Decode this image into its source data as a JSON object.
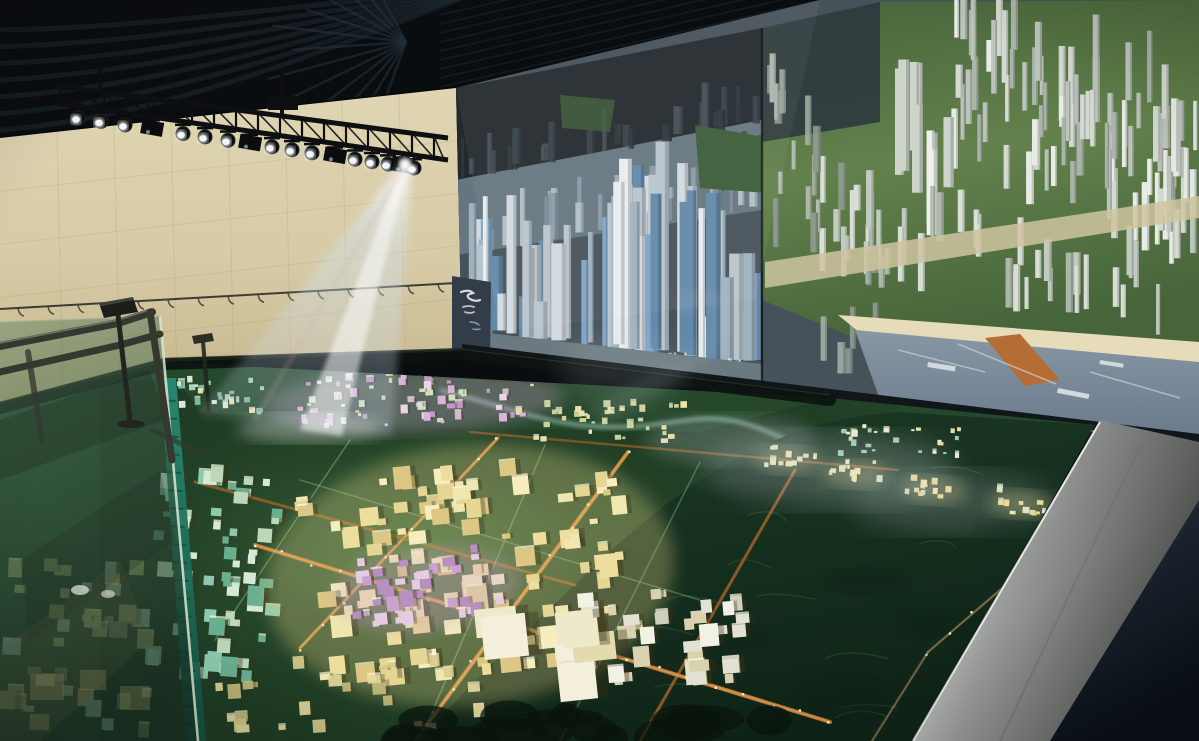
{
  "scene": {
    "label": "urban-planning-exhibition-hall",
    "elements": [
      "ceiling-swirl-panels",
      "spotlight-truss",
      "projector-beam",
      "tiled-wall",
      "video-wall-city-render",
      "residential-screen-panel",
      "city-scale-model",
      "glass-display-case",
      "metal-railing",
      "info-stand",
      "silver-table-edge",
      "mist-effect"
    ]
  },
  "palette": {
    "ceiling": "#0a0d10",
    "ceilingStripe": "#1d2a31",
    "ceilingRay": "#243039",
    "truss": "#0d0f11",
    "wall": "#d7cba6",
    "wallHi": "#e0d5b2",
    "wallShade": "#c3b489",
    "wallLine": "#8a7a52",
    "wire": "#3c3c32",
    "screenDark": "#232a2d",
    "screenDark2": "#2e383e",
    "screenMid": "#9aa7ae",
    "park": "#3c5c38",
    "hillB": "#62814c",
    "hillB2": "#47653a",
    "roadB": "#cfc4a0",
    "beach": "#e6dcba",
    "seaTop": "#8797a5",
    "seaBot": "#69798a",
    "pier": "#b56d36",
    "pierWhite": "#dce2e6",
    "bezel": "#10161a",
    "seam": "#0b0f12",
    "sidePanel": "#333d49",
    "calligraphy": "#e9edf1",
    "modelBase": "#24482c",
    "modelLight": "#3c6b3e",
    "hillsBack": "#26492c",
    "mountain1": "#1c3b25",
    "mountain2": "#0f2418",
    "ridge": "#3f6b35",
    "river": "#a8cdc4",
    "roadOrange": "#c8803a",
    "roadOrange2": "#a86628",
    "roadTan": "#c9a06a",
    "roadGreen": "#9fd0a0",
    "lightDot": "#fff8dc",
    "tealEdge": "#2a8a72",
    "tealEdgeDark": "#14503f",
    "glassTop": "#56805f",
    "glassBot": "#182c22",
    "glassEdge": "#d8e8d0",
    "rail": "#34382f",
    "railHi": "#7d8277",
    "standDark": "#1b1e1a",
    "silver1": "#f2f2ef",
    "silver2": "#9a9d9a",
    "silver3": "#51544f",
    "floor1": "#2a3745",
    "floor2": "#0c121a",
    "wallPiece": "#857f6d",
    "beamCore": "#ffffff",
    "beamEdge": "#cfe2f4",
    "beamPink": "#d9a8b0",
    "mist": "#ccd4d9"
  },
  "ceiling": {
    "swirl_count": 7,
    "ray_count": 13,
    "slat_count": 9
  },
  "truss": {
    "spotlight_xs": [
      78,
      101,
      125,
      152,
      183,
      205,
      228,
      250,
      272,
      292,
      312,
      335,
      355,
      372,
      388,
      402,
      414
    ],
    "box_indices": [
      3,
      7,
      11,
      15
    ],
    "lattice_step": 22
  },
  "wall": {
    "v_lines": 7,
    "h_lines": 4,
    "wire_hooks": 15
  },
  "videowall": {
    "seam_x": 762,
    "districts": [
      {
        "name": "far-silhouette",
        "x0": 462,
        "x1": 758,
        "b0": 178,
        "b1": 120,
        "n": 26,
        "w": [
          4,
          10
        ],
        "h": [
          14,
          45
        ],
        "colors": [
          "#39444b",
          "#2e383e",
          "#46525a"
        ],
        "op": 0.9
      },
      {
        "name": "mid-city",
        "x0": 462,
        "x1": 758,
        "b0": 252,
        "b1": 206,
        "n": 34,
        "w": [
          4,
          9
        ],
        "h": [
          18,
          60
        ],
        "colors": [
          "#9fadb6",
          "#8b9ba6",
          "#b6c2ca",
          "#7d8d99"
        ],
        "op": 0.95
      },
      {
        "name": "cbd-towers",
        "x0": 468,
        "x1": 756,
        "b0": 330,
        "b1": 364,
        "n": 58,
        "w": [
          5,
          15
        ],
        "h": [
          35,
          150
        ],
        "colors": [
          "#e8edf0",
          "#d3dbe0",
          "#b9c5cd",
          "#9fb2bf",
          "#7fa3c6",
          "#6288aa"
        ],
        "op": 1,
        "center_boost": true
      },
      {
        "name": "residential-dense",
        "x0": 952,
        "x1": 1196,
        "b0": 95,
        "b1": 195,
        "n": 85,
        "w": [
          4,
          8
        ],
        "h": [
          30,
          75
        ],
        "yj": 80,
        "colors": [
          "#e8ece6",
          "#d4dad2",
          "#bcc5bb",
          "#aab4a9"
        ],
        "op": 1
      },
      {
        "name": "residential-tall-pair",
        "x0": 884,
        "x1": 950,
        "b0": 150,
        "b1": 215,
        "n": 9,
        "w": [
          7,
          11
        ],
        "h": [
          70,
          135
        ],
        "yj": 40,
        "colors": [
          "#eef1ec",
          "#dde3db",
          "#cdd5cb"
        ],
        "op": 1
      },
      {
        "name": "residential-mid",
        "x0": 800,
        "x1": 1160,
        "b0": 235,
        "b1": 305,
        "n": 42,
        "w": [
          4,
          8
        ],
        "h": [
          25,
          60
        ],
        "yj": 40,
        "colors": [
          "#dfe5dd",
          "#c8d0c6",
          "#b2bcb0"
        ],
        "op": 0.95
      },
      {
        "name": "near-seam",
        "x0": 765,
        "x1": 880,
        "b0": 180,
        "b1": 330,
        "n": 24,
        "w": [
          4,
          8
        ],
        "h": [
          20,
          50
        ],
        "yj": 110,
        "colors": [
          "#aab4ac",
          "#94a096",
          "#c2cac0"
        ],
        "op": 0.85
      }
    ]
  },
  "model": {
    "clusters": [
      {
        "name": "back-teal",
        "cx": 215,
        "cy": 398,
        "w": 100,
        "h": 36,
        "n": 26,
        "rot": -2,
        "s": [
          3,
          7
        ],
        "colors": [
          "#9fd4bd",
          "#7ab89f",
          "#d8e8d8",
          "#e8e0b0"
        ]
      },
      {
        "name": "back-pink",
        "cx": 415,
        "cy": 400,
        "w": 240,
        "h": 52,
        "n": 72,
        "rot": -2,
        "s": [
          3,
          8
        ],
        "glow": "#d8a8d8",
        "colors": [
          "#d8b4da",
          "#c698c8",
          "#e9d6e6",
          "#e6d9a6",
          "#cfe0c0"
        ]
      },
      {
        "name": "back-yellow",
        "cx": 610,
        "cy": 424,
        "w": 150,
        "h": 40,
        "n": 36,
        "rot": -1,
        "s": [
          3,
          7
        ],
        "colors": [
          "#e8e2ae",
          "#d9d298",
          "#c4d4a0"
        ]
      },
      {
        "name": "back-right",
        "cx": 900,
        "cy": 443,
        "w": 120,
        "h": 30,
        "n": 26,
        "rot": 2,
        "s": [
          3,
          6
        ],
        "colors": [
          "#e6dfa8",
          "#99ccb4",
          "#f0ead0"
        ]
      },
      {
        "name": "valley-1",
        "cx": 788,
        "cy": 460,
        "w": 54,
        "h": 22,
        "n": 12,
        "rot": 3,
        "s": [
          3,
          6
        ],
        "glow": "#f0e098",
        "colors": [
          "#f6eab0",
          "#eeda8e",
          "#d8e8c0"
        ]
      },
      {
        "name": "valley-2",
        "cx": 856,
        "cy": 474,
        "w": 54,
        "h": 22,
        "n": 12,
        "rot": 3,
        "s": [
          3,
          6
        ],
        "glow": "#f0e098",
        "colors": [
          "#f6eab0",
          "#eeda8e",
          "#d8e8c0"
        ]
      },
      {
        "name": "valley-3",
        "cx": 934,
        "cy": 490,
        "w": 54,
        "h": 22,
        "n": 12,
        "rot": 4,
        "s": [
          3,
          6
        ],
        "glow": "#f0e098",
        "colors": [
          "#f6eab0",
          "#eeda8e",
          "#cde0b0"
        ]
      },
      {
        "name": "valley-4",
        "cx": 1022,
        "cy": 504,
        "w": 54,
        "h": 22,
        "n": 12,
        "rot": 4,
        "s": [
          3,
          6
        ],
        "glow": "#f0e098",
        "colors": [
          "#f6eab0",
          "#eeda8e",
          "#d8e8c0"
        ]
      },
      {
        "name": "valley-5",
        "cx": 1108,
        "cy": 518,
        "w": 56,
        "h": 24,
        "n": 13,
        "rot": 5,
        "s": [
          3,
          7
        ],
        "glow": "#f0e098",
        "colors": [
          "#f6eab0",
          "#eeda8e",
          "#cde0b0"
        ]
      },
      {
        "name": "valley-6",
        "cx": 1158,
        "cy": 478,
        "w": 46,
        "h": 20,
        "n": 10,
        "rot": 4,
        "s": [
          3,
          6
        ],
        "glow": "#f0e098",
        "colors": [
          "#f6eab0",
          "#eeda8e"
        ]
      },
      {
        "name": "teal-left",
        "cx": 215,
        "cy": 585,
        "w": 120,
        "h": 210,
        "n": 62,
        "rot": 4,
        "s": [
          5,
          13
        ],
        "colors": [
          "#8cc9ae",
          "#6aae90",
          "#d6e9d4",
          "#bcd8b8"
        ]
      },
      {
        "name": "cbd-yellow",
        "cx": 470,
        "cy": 575,
        "w": 330,
        "h": 210,
        "n": 115,
        "rot": -6,
        "s": [
          6,
          16
        ],
        "glow": "#e8d88a",
        "colors": [
          "#eede9e",
          "#f6eebe",
          "#dcc884",
          "#f0e7b0",
          "#e6d694"
        ]
      },
      {
        "name": "purple-mid",
        "cx": 425,
        "cy": 590,
        "w": 150,
        "h": 66,
        "n": 34,
        "rot": -6,
        "s": [
          5,
          11
        ],
        "glow": "#c9a0cc",
        "colors": [
          "#cba2cf",
          "#b98ec0",
          "#e3cce4"
        ]
      },
      {
        "name": "white-gray",
        "cx": 655,
        "cy": 645,
        "w": 180,
        "h": 95,
        "n": 40,
        "rot": -5,
        "s": [
          6,
          15
        ],
        "colors": [
          "#e2e2d4",
          "#cfcfc0",
          "#f1f1e4",
          "#d9d2ae"
        ]
      },
      {
        "name": "big-roofs",
        "cx": 560,
        "cy": 670,
        "w": 130,
        "h": 85,
        "n": 8,
        "rot": -6,
        "s": [
          18,
          34
        ],
        "colors": [
          "#efe9cc",
          "#e3daae",
          "#f4efda"
        ]
      },
      {
        "name": "under-glass",
        "cx": 80,
        "cy": 650,
        "w": 150,
        "h": 170,
        "n": 40,
        "rot": 3,
        "s": [
          6,
          14
        ],
        "op": 0.85,
        "colors": [
          "#9aa86c",
          "#b0b878",
          "#6f8c64",
          "#93c0a2"
        ]
      },
      {
        "name": "front-scatter",
        "cx": 350,
        "cy": 700,
        "w": 260,
        "h": 70,
        "n": 24,
        "rot": -4,
        "s": [
          5,
          10
        ],
        "op": 0.9,
        "colors": [
          "#d9cd8e",
          "#c9bd7e",
          "#e6dca0"
        ]
      }
    ],
    "roads": [
      {
        "x1": 415,
        "y1": 741,
        "x2": 628,
        "y2": 452,
        "w": 4,
        "c": "roadOrange",
        "op": 0.95,
        "lit": true
      },
      {
        "x1": 300,
        "y1": 648,
        "x2": 498,
        "y2": 438,
        "w": 3.2,
        "c": "roadOrange",
        "op": 0.85,
        "lit": true
      },
      {
        "x1": 640,
        "y1": 741,
        "x2": 795,
        "y2": 470,
        "w": 3,
        "c": "roadOrange2",
        "op": 0.8,
        "lit": false
      },
      {
        "x1": 255,
        "y1": 545,
        "x2": 830,
        "y2": 722,
        "w": 4,
        "c": "roadOrange",
        "op": 0.9,
        "lit": true
      },
      {
        "x1": 195,
        "y1": 482,
        "x2": 575,
        "y2": 585,
        "w": 3,
        "c": "roadOrange2",
        "op": 0.7,
        "lit": false
      },
      {
        "x1": 470,
        "y1": 432,
        "x2": 898,
        "y2": 470,
        "w": 2.5,
        "c": "roadOrange2",
        "op": 0.6,
        "lit": false
      },
      {
        "x1": 1160,
        "y1": 452,
        "x2": 928,
        "y2": 652,
        "w": 2.2,
        "c": "roadTan",
        "op": 0.55,
        "lit": true
      },
      {
        "x1": 928,
        "y1": 652,
        "x2": 872,
        "y2": 741,
        "w": 2.2,
        "c": "roadTan",
        "op": 0.5,
        "lit": false
      },
      {
        "x1": 1199,
        "y1": 524,
        "x2": 1008,
        "y2": 706,
        "w": 1.8,
        "c": "roadTan",
        "op": 0.4,
        "lit": false
      },
      {
        "x1": 350,
        "y1": 440,
        "x2": 215,
        "y2": 640,
        "w": 1.5,
        "c": "roadGreen",
        "op": 0.4,
        "lit": false
      },
      {
        "x1": 545,
        "y1": 445,
        "x2": 420,
        "y2": 741,
        "w": 1.5,
        "c": "roadGreen",
        "op": 0.4,
        "lit": false
      },
      {
        "x1": 700,
        "y1": 462,
        "x2": 560,
        "y2": 741,
        "w": 1.5,
        "c": "roadGreen",
        "op": 0.35,
        "lit": false
      },
      {
        "x1": 300,
        "y1": 480,
        "x2": 700,
        "y2": 600,
        "w": 1.5,
        "c": "roadGreen",
        "op": 0.35,
        "lit": false
      }
    ],
    "ridge_strokes": 16,
    "foliage_blobs": 16
  }
}
